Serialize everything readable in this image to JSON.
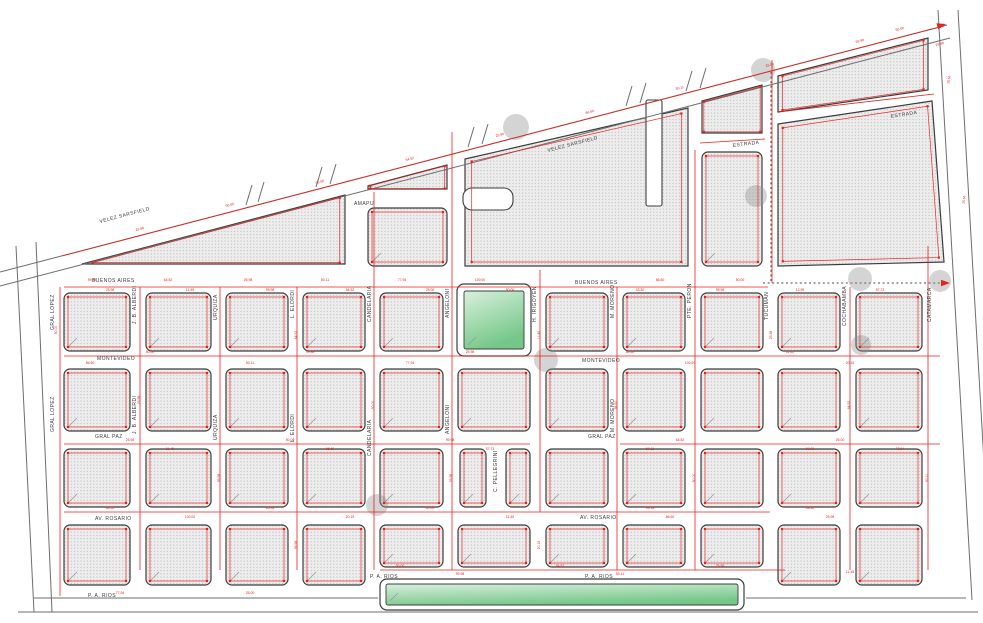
{
  "title": "cadastral-street-map",
  "colors": {
    "survey_red": "#e8211b",
    "block_outline": "#3c3c3c",
    "street_gray": "#6e6e6e",
    "park_green_light": "#d9f0dc",
    "park_green": "#74c788",
    "circle_gray": "#8f8f8f"
  },
  "map": {
    "width": 983,
    "height": 623,
    "street_labels": [
      {
        "t": "VELEZ SARSFIELD",
        "x": 100,
        "y": 223,
        "r": -14.6,
        "s": 5
      },
      {
        "t": "VELEZ SARSFIELD",
        "x": 548,
        "y": 152,
        "r": -14.6,
        "s": 5
      },
      {
        "t": "ESTRADA",
        "x": 733,
        "y": 147,
        "r": -7,
        "s": 4.6
      },
      {
        "t": "ESTRADA",
        "x": 891,
        "y": 118,
        "r": -9,
        "s": 4.6
      },
      {
        "t": "AMAPU",
        "x": 354,
        "y": 205,
        "r": 0,
        "s": 4.2
      },
      {
        "t": "BUENOS AIRES",
        "x": 92,
        "y": 282,
        "r": 0,
        "s": 5
      },
      {
        "t": "BUENOS AIRES",
        "x": 575,
        "y": 284,
        "r": 0,
        "s": 5
      },
      {
        "t": "MONTEVIDEO",
        "x": 97,
        "y": 360,
        "r": 0,
        "s": 5
      },
      {
        "t": "MONTEVIDEO",
        "x": 582,
        "y": 362,
        "r": 0,
        "s": 5
      },
      {
        "t": "GRAL PAZ",
        "x": 95,
        "y": 438,
        "r": 0,
        "s": 5
      },
      {
        "t": "GRAL PAZ",
        "x": 588,
        "y": 438,
        "r": 0,
        "s": 5
      },
      {
        "t": "AV. ROSARIO",
        "x": 95,
        "y": 520,
        "r": 0,
        "s": 5
      },
      {
        "t": "AV. ROSARIO",
        "x": 580,
        "y": 519,
        "r": 0,
        "s": 5
      },
      {
        "t": "P. A. RIOS",
        "x": 88,
        "y": 597,
        "r": 0,
        "s": 5
      },
      {
        "t": "P. A. RIOS",
        "x": 370,
        "y": 578,
        "r": 0,
        "s": 5
      },
      {
        "t": "P. A. RIOS",
        "x": 585,
        "y": 578,
        "r": 0,
        "s": 5
      },
      {
        "t": "GRAL LOPEZ",
        "x": 54,
        "y": 330,
        "r": -90,
        "s": 4.6
      },
      {
        "t": "GRAL LOPEZ",
        "x": 54,
        "y": 432,
        "r": -90,
        "s": 4.6
      },
      {
        "t": "J. B. ALBERDI",
        "x": 136,
        "y": 324,
        "r": -90,
        "s": 4.6
      },
      {
        "t": "J. B. ALBERDI",
        "x": 136,
        "y": 434,
        "r": -90,
        "s": 4.6
      },
      {
        "t": "URQUIZA",
        "x": 217,
        "y": 320,
        "r": -90,
        "s": 4.6
      },
      {
        "t": "URQUIZA",
        "x": 217,
        "y": 440,
        "r": -90,
        "s": 4.6
      },
      {
        "t": "L. ELORDI",
        "x": 294,
        "y": 318,
        "r": -90,
        "s": 4.6
      },
      {
        "t": "L. ELORDI",
        "x": 294,
        "y": 442,
        "r": -90,
        "s": 4.6
      },
      {
        "t": "CANDELARIA",
        "x": 371,
        "y": 322,
        "r": -90,
        "s": 4.6
      },
      {
        "t": "CANDELARIA",
        "x": 371,
        "y": 456,
        "r": -90,
        "s": 4.6
      },
      {
        "t": "ANGELONI",
        "x": 449,
        "y": 318,
        "r": -90,
        "s": 4.6
      },
      {
        "t": "ANGELONI",
        "x": 449,
        "y": 434,
        "r": -90,
        "s": 4.6
      },
      {
        "t": "H. IRIGOYEN",
        "x": 536,
        "y": 322,
        "r": -90,
        "s": 4.6
      },
      {
        "t": "C. PELLEGRINI",
        "x": 497,
        "y": 492,
        "r": -90,
        "s": 4
      },
      {
        "t": "M. MORENO",
        "x": 614,
        "y": 318,
        "r": -90,
        "s": 4.6
      },
      {
        "t": "M. MORENO",
        "x": 614,
        "y": 432,
        "r": -90,
        "s": 4.6
      },
      {
        "t": "PTE. PERON",
        "x": 691,
        "y": 318,
        "r": -90,
        "s": 4.6
      },
      {
        "t": "TUCUMAN",
        "x": 768,
        "y": 320,
        "r": -90,
        "s": 4.6
      },
      {
        "t": "COCHABAMBA",
        "x": 846,
        "y": 326,
        "r": -90,
        "s": 4.6
      },
      {
        "t": "CATAMARCA",
        "x": 931,
        "y": 322,
        "r": -90,
        "s": 4.6
      }
    ],
    "measurements": [
      [
        92,
        281,
        0,
        "99.98"
      ],
      [
        168,
        281,
        0,
        "64.52"
      ],
      [
        248,
        281,
        0,
        "25.98"
      ],
      [
        325,
        281,
        0,
        "50.11"
      ],
      [
        402,
        281,
        0,
        "77.94"
      ],
      [
        480,
        281,
        0,
        "100.00"
      ],
      [
        660,
        281,
        0,
        "86.60"
      ],
      [
        740,
        281,
        0,
        "50.00"
      ],
      [
        110,
        291,
        0,
        "25.98"
      ],
      [
        190,
        291,
        0,
        "11.45"
      ],
      [
        270,
        291,
        0,
        "99.98"
      ],
      [
        350,
        291,
        0,
        "64.52"
      ],
      [
        430,
        291,
        0,
        "25.00"
      ],
      [
        510,
        291,
        0,
        "50.00"
      ],
      [
        640,
        291,
        0,
        "43.30"
      ],
      [
        720,
        291,
        0,
        "99.98"
      ],
      [
        800,
        291,
        0,
        "12.99"
      ],
      [
        880,
        291,
        0,
        "57.73"
      ],
      [
        150,
        353,
        0,
        "50.00"
      ],
      [
        310,
        353,
        0,
        "99.98"
      ],
      [
        470,
        353,
        0,
        "25.98"
      ],
      [
        630,
        353,
        0,
        "64.52"
      ],
      [
        790,
        353,
        0,
        "11.45"
      ],
      [
        90,
        364,
        0,
        "86.60"
      ],
      [
        250,
        364,
        0,
        "50.11"
      ],
      [
        410,
        364,
        0,
        "77.94"
      ],
      [
        690,
        364,
        0,
        "100.00"
      ],
      [
        850,
        364,
        0,
        "20.15"
      ],
      [
        130,
        441,
        0,
        "25.98"
      ],
      [
        290,
        441,
        0,
        "50.00"
      ],
      [
        450,
        441,
        0,
        "99.98"
      ],
      [
        680,
        441,
        0,
        "64.52"
      ],
      [
        840,
        441,
        0,
        "25.00"
      ],
      [
        170,
        450,
        0,
        "11.45"
      ],
      [
        330,
        450,
        0,
        "86.60"
      ],
      [
        490,
        450,
        0,
        "57.73"
      ],
      [
        650,
        450,
        0,
        "50.11"
      ],
      [
        810,
        450,
        0,
        "99.98"
      ],
      [
        900,
        450,
        0,
        "77.94"
      ],
      [
        110,
        509,
        0,
        "64.52"
      ],
      [
        270,
        509,
        0,
        "25.98"
      ],
      [
        430,
        509,
        0,
        "50.00"
      ],
      [
        650,
        509,
        0,
        "99.98"
      ],
      [
        810,
        509,
        0,
        "43.30"
      ],
      [
        190,
        518,
        0,
        "100.00"
      ],
      [
        350,
        518,
        0,
        "20.15"
      ],
      [
        510,
        518,
        0,
        "11.45"
      ],
      [
        670,
        518,
        0,
        "86.60"
      ],
      [
        830,
        518,
        0,
        "25.98"
      ],
      [
        400,
        567,
        0,
        "50.00"
      ],
      [
        560,
        567,
        0,
        "64.52"
      ],
      [
        720,
        567,
        0,
        "25.98"
      ],
      [
        460,
        575,
        0,
        "99.98"
      ],
      [
        620,
        575,
        0,
        "50.11"
      ],
      [
        120,
        594,
        0,
        "77.94"
      ],
      [
        250,
        594,
        0,
        "25.00"
      ],
      [
        850,
        573,
        0,
        "11.45"
      ],
      [
        140,
        230,
        -14.6,
        "25.98"
      ],
      [
        230,
        206,
        -14.6,
        "50.00"
      ],
      [
        320,
        183,
        -14.6,
        "99.98"
      ],
      [
        410,
        160,
        -14.6,
        "64.52"
      ],
      [
        500,
        136,
        -14.6,
        "25.98"
      ],
      [
        590,
        113,
        -14.6,
        "86.60"
      ],
      [
        680,
        89,
        -14.6,
        "50.11"
      ],
      [
        770,
        66,
        -14.6,
        "25.00"
      ],
      [
        860,
        42,
        -14.6,
        "99.98"
      ],
      [
        57,
        330,
        -90,
        "50.00"
      ],
      [
        140,
        400,
        -90,
        "25.98"
      ],
      [
        220,
        478,
        -90,
        "99.98"
      ],
      [
        297,
        335,
        -90,
        "64.52"
      ],
      [
        374,
        405,
        -90,
        "50.00"
      ],
      [
        452,
        478,
        -90,
        "25.98"
      ],
      [
        540,
        335,
        -90,
        "11.45"
      ],
      [
        617,
        405,
        -90,
        "86.60"
      ],
      [
        695,
        478,
        -90,
        "50.00"
      ],
      [
        772,
        335,
        -90,
        "25.98"
      ],
      [
        850,
        405,
        -90,
        "64.52"
      ],
      [
        928,
        478,
        -90,
        "50.11"
      ],
      [
        540,
        545,
        -90,
        "20.15"
      ],
      [
        297,
        545,
        -90,
        "99.98"
      ],
      [
        950,
        80,
        -80,
        "25 M"
      ],
      [
        965,
        200,
        -85,
        "25 M"
      ],
      [
        940,
        45,
        -15,
        "25.98"
      ],
      [
        900,
        30,
        -14.6,
        "50.00"
      ]
    ],
    "rect_blocks": [
      [
        64,
        293,
        66,
        58
      ],
      [
        146,
        293,
        65,
        58
      ],
      [
        226,
        293,
        62,
        58
      ],
      [
        303,
        293,
        62,
        58
      ],
      [
        380,
        293,
        63,
        58
      ],
      [
        546,
        293,
        62,
        58
      ],
      [
        623,
        293,
        62,
        58
      ],
      [
        701,
        293,
        62,
        58
      ],
      [
        778,
        293,
        62,
        58
      ],
      [
        856,
        293,
        66,
        58
      ],
      [
        64,
        369,
        66,
        62
      ],
      [
        146,
        369,
        65,
        62
      ],
      [
        226,
        369,
        62,
        62
      ],
      [
        303,
        369,
        62,
        62
      ],
      [
        380,
        369,
        63,
        62
      ],
      [
        458,
        369,
        72,
        62
      ],
      [
        546,
        369,
        62,
        62
      ],
      [
        623,
        369,
        62,
        62
      ],
      [
        701,
        369,
        62,
        62
      ],
      [
        778,
        369,
        62,
        62
      ],
      [
        856,
        369,
        66,
        62
      ],
      [
        64,
        449,
        66,
        58
      ],
      [
        146,
        449,
        65,
        58
      ],
      [
        226,
        449,
        62,
        58
      ],
      [
        303,
        449,
        62,
        58
      ],
      [
        380,
        449,
        63,
        58
      ],
      [
        460,
        449,
        26,
        58
      ],
      [
        506,
        449,
        24,
        58
      ],
      [
        546,
        449,
        62,
        58
      ],
      [
        623,
        449,
        62,
        58
      ],
      [
        701,
        449,
        62,
        58
      ],
      [
        778,
        449,
        62,
        58
      ],
      [
        856,
        449,
        66,
        58
      ],
      [
        64,
        525,
        66,
        60
      ],
      [
        146,
        525,
        65,
        60
      ],
      [
        226,
        525,
        62,
        60
      ],
      [
        303,
        525,
        62,
        60
      ],
      [
        778,
        525,
        62,
        60
      ],
      [
        856,
        525,
        66,
        60
      ],
      [
        380,
        525,
        63,
        42
      ],
      [
        458,
        525,
        72,
        42
      ],
      [
        546,
        525,
        62,
        42
      ],
      [
        623,
        525,
        62,
        42
      ],
      [
        701,
        525,
        62,
        42
      ],
      [
        368,
        208,
        79,
        58
      ],
      [
        702,
        152,
        60,
        114
      ]
    ],
    "poly_blocks": [
      "82,264 345,195 345,264",
      "368,186 447,165 447,189 368,189",
      "465,159 688,108 688,266 465,266",
      "702,101 762,85 762,133 702,133",
      "778,76 928,38 928,90 778,112",
      "778,124 932,101 944,262 778,266"
    ],
    "street_notches": [
      {
        "x": 646,
        "y": 100,
        "w": 16,
        "h": 106,
        "rx": 2
      },
      {
        "x": 463,
        "y": 188,
        "w": 50,
        "h": 22,
        "rx": 9
      }
    ],
    "parks": [
      {
        "ox": 457,
        "oy": 284,
        "ow": 74,
        "oh": 72,
        "ix": 464,
        "iy": 291,
        "iw": 60,
        "ih": 58
      },
      {
        "ox": 380,
        "oy": 579,
        "ow": 364,
        "oh": 31,
        "ix": 386,
        "iy": 584,
        "iw": 352,
        "ih": 21
      }
    ],
    "gray_lines": [
      [
        0,
        272,
        947,
        25
      ],
      [
        0,
        286,
        950,
        38
      ],
      [
        16,
        246,
        34,
        612
      ],
      [
        36,
        242,
        52,
        612
      ],
      [
        938,
        10,
        972,
        600
      ],
      [
        958,
        10,
        992,
        602
      ],
      [
        34,
        598,
        378,
        598
      ],
      [
        746,
        598,
        966,
        598
      ],
      [
        18,
        612,
        978,
        612
      ],
      [
        246,
        205,
        252,
        185
      ],
      [
        258,
        202,
        264,
        182
      ],
      [
        316,
        187,
        322,
        167
      ],
      [
        330,
        184,
        336,
        164
      ],
      [
        468,
        147,
        474,
        127
      ],
      [
        482,
        144,
        488,
        124
      ],
      [
        626,
        106,
        632,
        86
      ],
      [
        640,
        103,
        646,
        83
      ],
      [
        686,
        91,
        692,
        71
      ],
      [
        700,
        88,
        706,
        68
      ]
    ],
    "red_lines": [
      [
        62,
        256,
        944,
        26
      ],
      [
        64,
        287,
        768,
        287
      ],
      [
        64,
        356,
        940,
        356
      ],
      [
        64,
        444,
        530,
        444
      ],
      [
        620,
        444,
        940,
        444
      ],
      [
        64,
        512,
        770,
        512
      ],
      [
        380,
        570,
        785,
        570
      ],
      [
        60,
        287,
        60,
        596
      ],
      [
        140,
        287,
        140,
        570
      ],
      [
        220,
        287,
        220,
        570
      ],
      [
        297,
        287,
        297,
        570
      ],
      [
        374,
        192,
        374,
        570
      ],
      [
        452,
        132,
        452,
        570
      ],
      [
        540,
        270,
        540,
        512
      ],
      [
        617,
        287,
        617,
        570
      ],
      [
        695,
        150,
        695,
        570
      ],
      [
        772,
        60,
        772,
        283
      ],
      [
        850,
        287,
        850,
        570
      ],
      [
        928,
        246,
        928,
        570
      ],
      [
        700,
        143,
        765,
        139
      ],
      [
        778,
        112,
        934,
        94
      ]
    ],
    "dashed_lines": [
      [
        771,
        72,
        771,
        281
      ],
      [
        763,
        283,
        948,
        283
      ]
    ],
    "circles": [
      [
        516,
        127,
        13
      ],
      [
        763,
        70,
        12
      ],
      [
        756,
        196,
        11
      ],
      [
        860,
        279,
        12
      ],
      [
        940,
        281,
        11
      ],
      [
        546,
        360,
        12
      ],
      [
        377,
        505,
        11
      ],
      [
        861,
        345,
        10
      ]
    ],
    "arrows": [
      {
        "x": 950,
        "y": 283,
        "r": 0
      },
      {
        "x": 946,
        "y": 24,
        "r": -15
      }
    ]
  }
}
